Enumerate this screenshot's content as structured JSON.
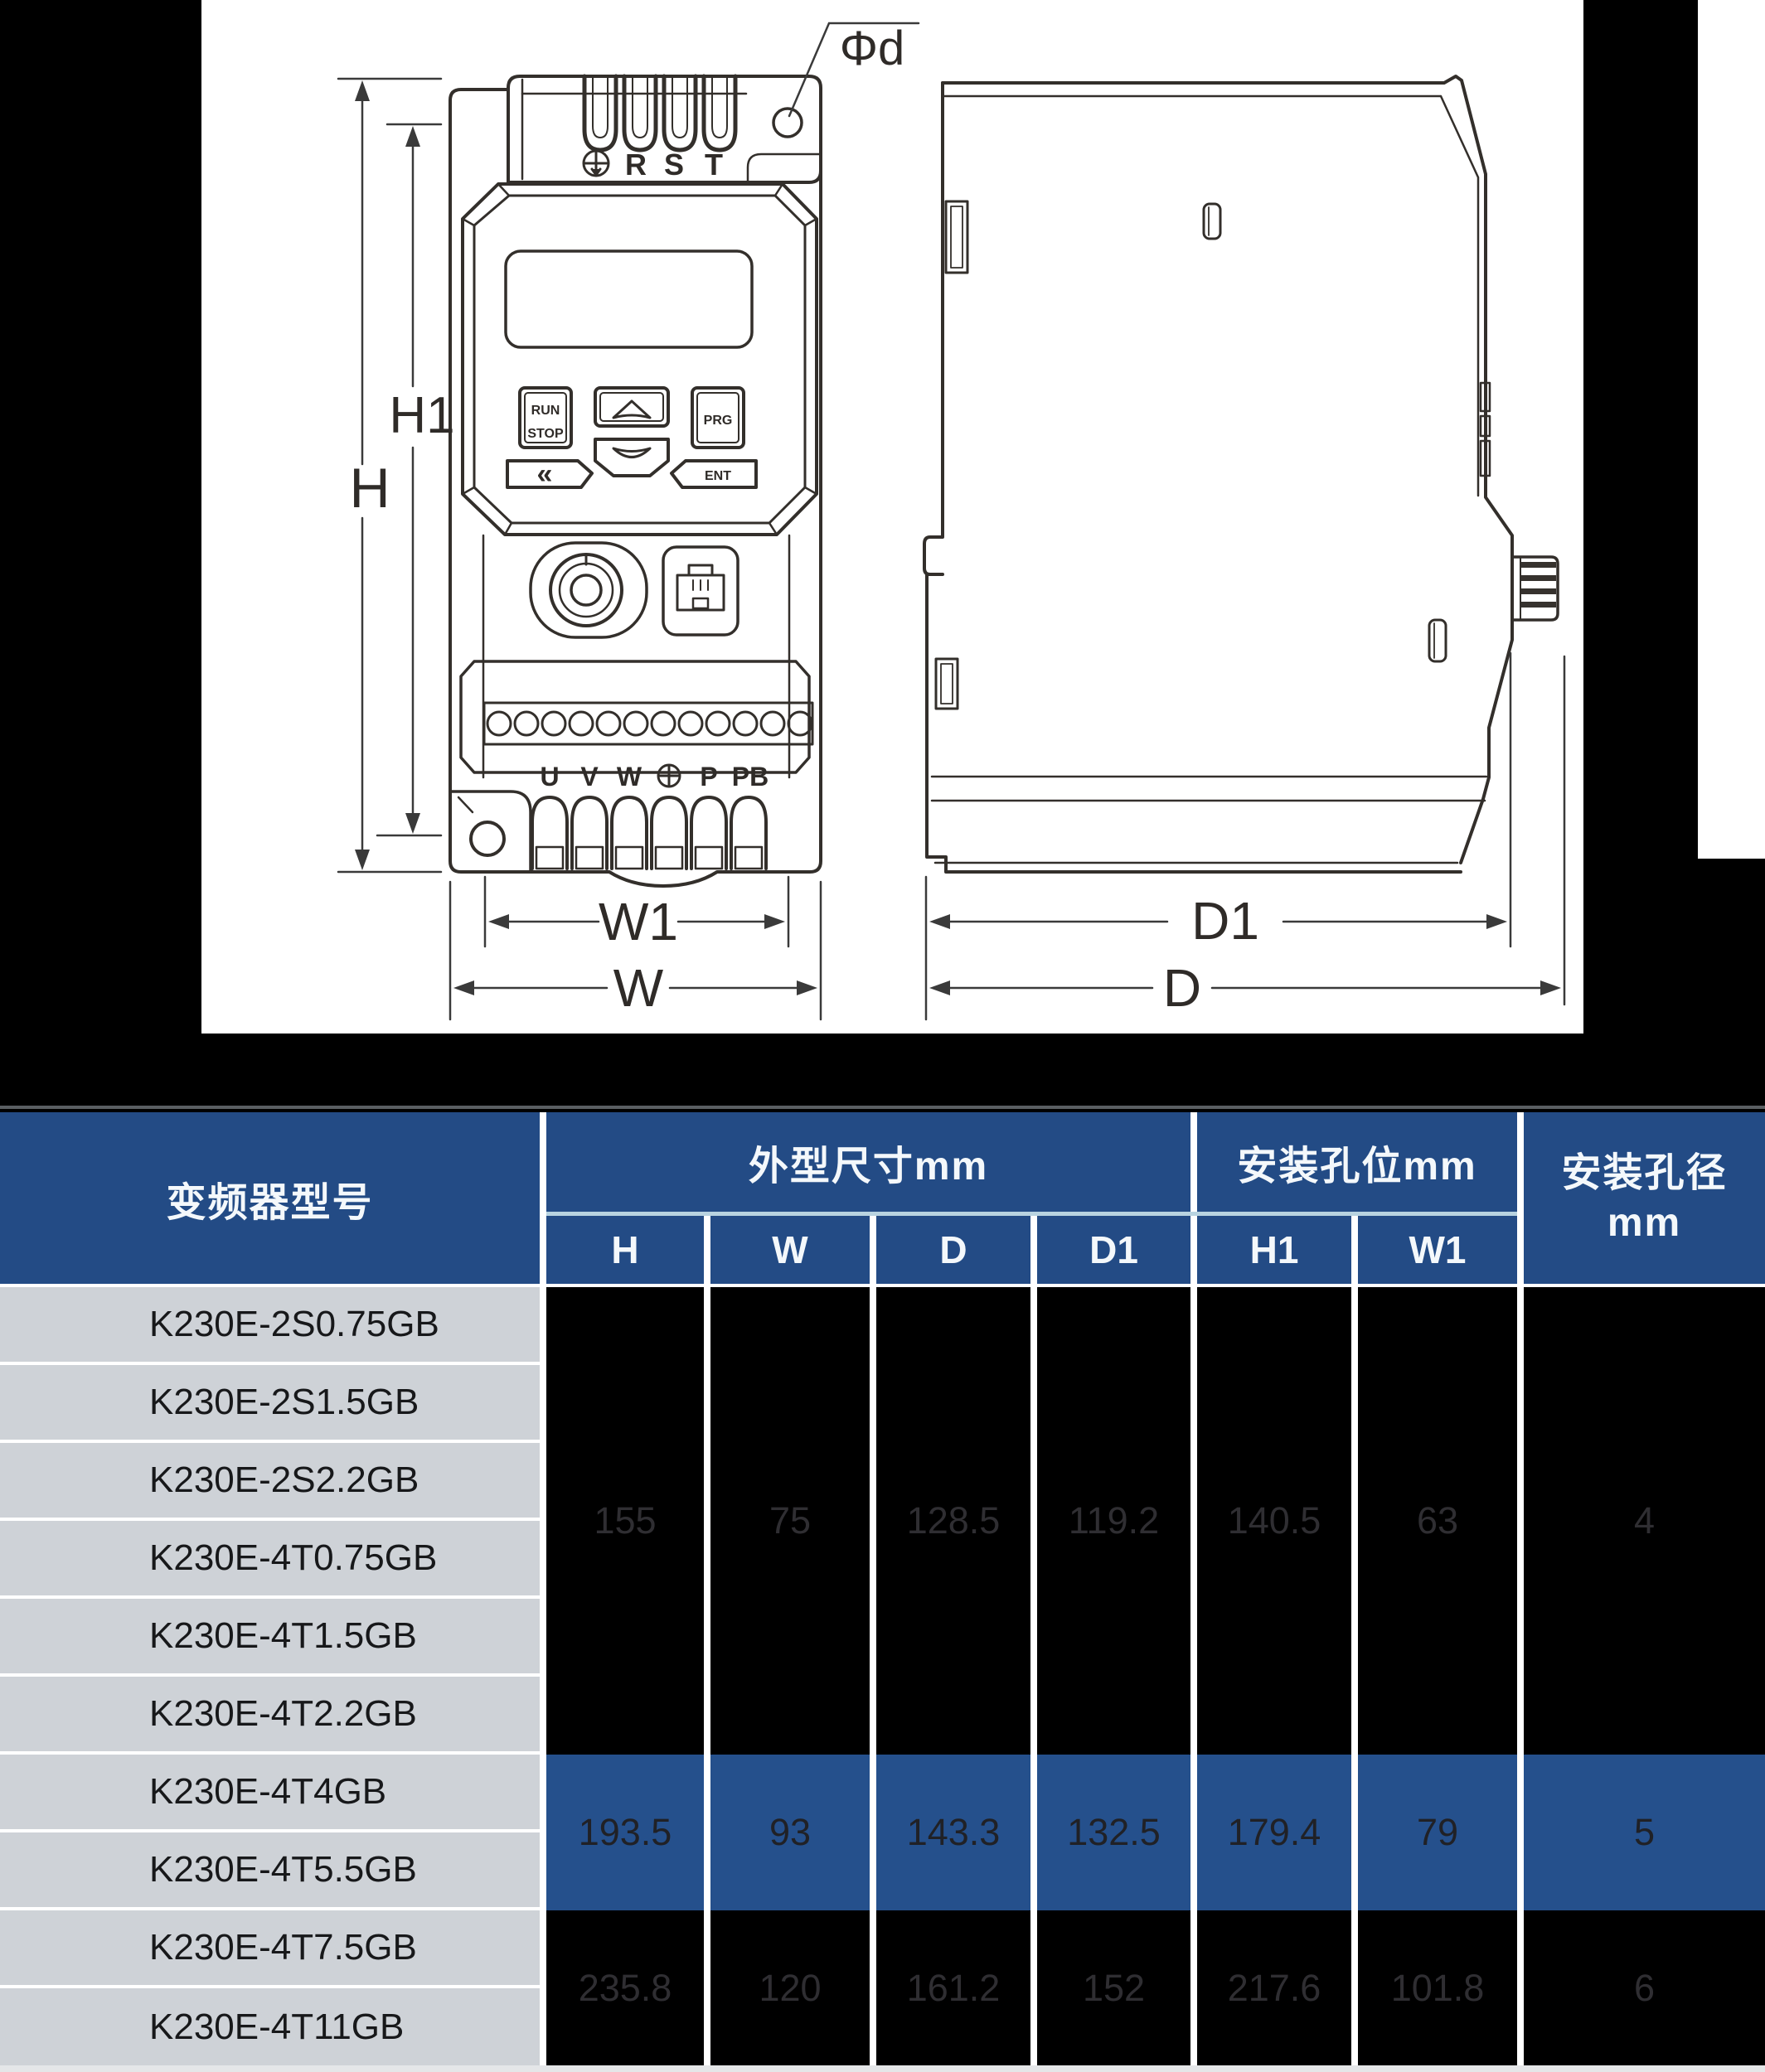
{
  "drawing": {
    "front": {
      "dim_h": "H",
      "dim_h1": "H1",
      "dim_w": "W",
      "dim_w1": "W1",
      "hole_callout": "Φd",
      "terminal_r": "R",
      "terminal_s": "S",
      "terminal_t": "T",
      "keypad": {
        "run": "RUN",
        "stop": "STOP",
        "prg": "PRG",
        "ent": "ENT",
        "back": "«"
      },
      "out_u": "U",
      "out_v": "V",
      "out_w": "W",
      "out_p": "P",
      "out_pb": "PB"
    },
    "side": {
      "dim_d": "D",
      "dim_d1": "D1"
    }
  },
  "table": {
    "header": {
      "model": "变频器型号",
      "dims_group": "外型尺寸mm",
      "holes_group": "安装孔位mm",
      "diameter_line1": "安装孔径",
      "diameter_line2": "mm"
    },
    "sub": [
      "H",
      "W",
      "D",
      "D1",
      "H1",
      "W1"
    ],
    "models": [
      "K230E-2S0.75GB",
      "K230E-2S1.5GB",
      "K230E-2S2.2GB",
      "K230E-4T0.75GB",
      "K230E-4T1.5GB",
      "K230E-4T2.2GB",
      "K230E-4T4GB",
      "K230E-4T5.5GB",
      "K230E-4T7.5GB",
      "K230E-4T11GB"
    ],
    "blocks": [
      {
        "rows": "1-6",
        "highlight": false,
        "values": [
          "155",
          "75",
          "128.5",
          "119.2",
          "140.5",
          "63",
          "4"
        ]
      },
      {
        "rows": "7-8",
        "highlight": true,
        "values": [
          "193.5",
          "93",
          "143.3",
          "132.5",
          "179.4",
          "79",
          "5"
        ]
      },
      {
        "rows": "9-10",
        "highlight": false,
        "values": [
          "235.8",
          "120",
          "161.2",
          "152",
          "217.6",
          "101.8",
          "6"
        ]
      }
    ]
  },
  "colors": {
    "page_background": "#000000",
    "drawing_panel": "#ffffff",
    "header_blue": "#234b85",
    "highlight_blue": "#25508c",
    "model_cell_gray": "#ced2d7",
    "group_underline": "#b8d3e0",
    "dark_value_text": "#2f2e32",
    "line_art": "#332f2b",
    "bottom_strip": "#e4e6e8"
  }
}
